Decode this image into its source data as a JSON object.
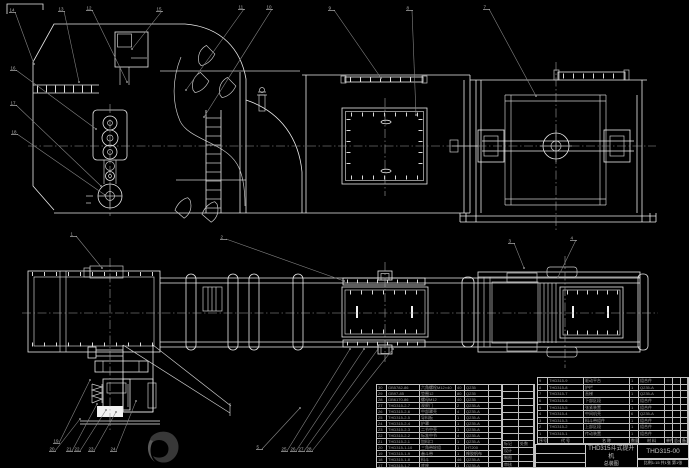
{
  "title_block": {
    "product": "THD315斗式提升机",
    "doc_type": "总装图",
    "drawing_no": "THD315-00",
    "footer_note": "比例1:15 共1张 第1张",
    "rev_rows": [
      [
        "",
        ""
      ],
      [
        "",
        ""
      ],
      [
        "",
        ""
      ],
      [
        "",
        ""
      ],
      [
        "",
        ""
      ],
      [
        "",
        ""
      ],
      [
        "",
        ""
      ],
      [
        "",
        ""
      ],
      [
        "标记",
        "处数"
      ],
      [
        "设计",
        ""
      ],
      [
        "制图",
        ""
      ],
      [
        "审核",
        ""
      ]
    ],
    "sig_ext_rows": [
      "",
      "",
      ""
    ]
  },
  "bom_left": {
    "rows": [
      [
        "30",
        "GB5782-86",
        "六角螺栓M12×40",
        "40",
        "Q235",
        ""
      ],
      [
        "29",
        "GB97-85",
        "垫圈12",
        "80",
        "Q235",
        ""
      ],
      [
        "28",
        "GB6170-86",
        "螺母M12",
        "40",
        "Q235",
        ""
      ],
      [
        "27",
        "THD315-2-7",
        "观察门",
        "2",
        "Q235-A",
        ""
      ],
      [
        "26",
        "THD315-2-6",
        "中部罩壳",
        "4",
        "Q235-A",
        ""
      ],
      [
        "25",
        "THD315-2-5",
        "导料板",
        "1",
        "Q235-A",
        ""
      ],
      [
        "24",
        "THD315-2-4",
        "护罩",
        "1",
        "Q235-A",
        ""
      ],
      [
        "23",
        "THD315-2-3",
        "二节中壳",
        "1",
        "Q235-A",
        ""
      ],
      [
        "22",
        "THD315-2-2",
        "标准中节",
        "4",
        "Q235-A",
        ""
      ],
      [
        "21",
        "THD315-2-1",
        "加料口",
        "1",
        "Q235-A",
        ""
      ],
      [
        "20",
        "THD315-1-10",
        "三角带轮组",
        "1",
        "HT200",
        ""
      ],
      [
        "19",
        "THD315-1-9",
        "畚斗带",
        "1",
        "橡胶帆布",
        ""
      ],
      [
        "18",
        "THD315-1-8",
        "料斗",
        "46",
        "Q235-A",
        ""
      ],
      [
        "17",
        "THD315-1-7",
        "底座",
        "1",
        "Q235-A",
        ""
      ]
    ]
  },
  "bom_right": {
    "header": [
      "序号",
      "代 号",
      "名 称",
      "数量",
      "材 料",
      "单件",
      "总计",
      "备注"
    ],
    "rows": [
      [
        "9",
        "THD315-9",
        "驱动平台",
        "1",
        "组合件",
        "",
        "",
        ""
      ],
      [
        "8",
        "THD315-8",
        "护栏",
        "1",
        "Q235-A",
        "",
        "",
        ""
      ],
      [
        "7",
        "THD315-7",
        "直梯",
        "1",
        "Q235-A",
        "",
        "",
        ""
      ],
      [
        "6",
        "THD315-6",
        "下部区段",
        "1",
        "组合件",
        "",
        "",
        ""
      ],
      [
        "5",
        "THD315-5",
        "张紧装置",
        "1",
        "组合件",
        "",
        "",
        ""
      ],
      [
        "4",
        "THD315-4",
        "中间机壳",
        "6",
        "Q235-A",
        "",
        "",
        ""
      ],
      [
        "3",
        "THD315-3",
        "料斗带组件",
        "1",
        "组合件",
        "",
        "",
        ""
      ],
      [
        "2",
        "THD315-2",
        "上部区段",
        "1",
        "组合件",
        "",
        "",
        ""
      ],
      [
        "1",
        "THD315-1",
        "传动装置",
        "1",
        "组合件",
        "",
        "",
        ""
      ]
    ]
  },
  "callouts": [
    {
      "label": "14",
      "x": 9,
      "y": 8,
      "ex": 34,
      "ey": 64
    },
    {
      "label": "13",
      "x": 58,
      "y": 7,
      "ex": 79,
      "ey": 82
    },
    {
      "label": "12",
      "x": 86,
      "y": 6,
      "ex": 127,
      "ey": 82
    },
    {
      "label": "15",
      "x": 156,
      "y": 7,
      "ex": 132,
      "ey": 49
    },
    {
      "label": "11",
      "x": 238,
      "y": 5,
      "ex": 186,
      "ey": 90
    },
    {
      "label": "10",
      "x": 266,
      "y": 5,
      "ex": 204,
      "ey": 117
    },
    {
      "label": "9",
      "x": 328,
      "y": 6,
      "ex": 381,
      "ey": 78
    },
    {
      "label": "8",
      "x": 406,
      "y": 6,
      "ex": 416,
      "ey": 115
    },
    {
      "label": "7",
      "x": 483,
      "y": 5,
      "ex": 536,
      "ey": 96
    },
    {
      "label": "16",
      "x": 10,
      "y": 66,
      "ex": 96,
      "ey": 129
    },
    {
      "label": "17",
      "x": 10,
      "y": 101,
      "ex": 101,
      "ey": 186
    },
    {
      "label": "18",
      "x": 11,
      "y": 130,
      "ex": 105,
      "ey": 195
    },
    {
      "label": "1",
      "x": 70,
      "y": 232,
      "ex": 102,
      "ey": 268
    },
    {
      "label": "2",
      "x": 220,
      "y": 235,
      "ex": 344,
      "ey": 281
    },
    {
      "label": "3",
      "x": 508,
      "y": 239,
      "ex": 524,
      "ey": 268
    },
    {
      "label": "4",
      "x": 570,
      "y": 236,
      "ex": 558,
      "ey": 277
    },
    {
      "label": "19",
      "x": 53,
      "y": 439,
      "ex": 90,
      "ey": 380
    },
    {
      "label": "20",
      "x": 49,
      "y": 447,
      "ex": 80,
      "ey": 419
    },
    {
      "label": "21",
      "x": 66,
      "y": 447,
      "ex": 97,
      "ey": 404
    },
    {
      "label": "22",
      "x": 74,
      "y": 447,
      "ex": 106,
      "ey": 410
    },
    {
      "label": "23",
      "x": 88,
      "y": 447,
      "ex": 116,
      "ey": 412
    },
    {
      "label": "24",
      "x": 110,
      "y": 447,
      "ex": 136,
      "ey": 401
    },
    {
      "label": "5",
      "x": 256,
      "y": 445,
      "ex": 300,
      "ey": 408
    },
    {
      "label": "25",
      "x": 281,
      "y": 447,
      "ex": 350,
      "ey": 349
    },
    {
      "label": "26",
      "x": 290,
      "y": 447,
      "ex": 364,
      "ey": 349
    },
    {
      "label": "27",
      "x": 298,
      "y": 447,
      "ex": 378,
      "ey": 349
    },
    {
      "label": "28",
      "x": 306,
      "y": 447,
      "ex": 393,
      "ey": 349
    }
  ],
  "colors": {
    "background": "#000000",
    "line": "#e9e9e9",
    "leader": "#858585",
    "table_line": "#c4c4c4",
    "text": "#a2a2a2",
    "watermark": "#383838"
  }
}
